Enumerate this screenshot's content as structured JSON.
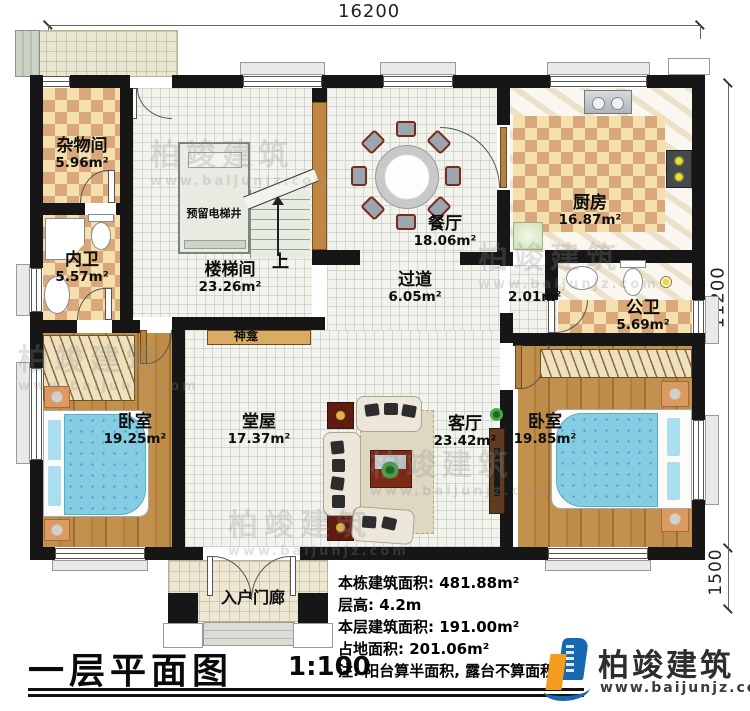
{
  "dimensions": {
    "top": "16200",
    "right": "11200",
    "porch": "1500"
  },
  "rooms": {
    "zawujian": {
      "name": "杂物间",
      "area": "5.96m²"
    },
    "neiwei": {
      "name": "内卫",
      "area": "5.57m²"
    },
    "loutijian": {
      "name": "楼梯间",
      "area": "23.26m²"
    },
    "canting": {
      "name": "餐厅",
      "area": "18.06m²"
    },
    "chufang": {
      "name": "厨房",
      "area": "16.87m²"
    },
    "guodao": {
      "name": "过道",
      "area": "6.05m²"
    },
    "corridor": {
      "area": "2.01m²"
    },
    "gongwei": {
      "name": "公卫",
      "area": "5.69m²"
    },
    "bedroom_left": {
      "name": "卧室",
      "area": "19.25m²"
    },
    "tangwu": {
      "name": "堂屋",
      "area": "17.37m²"
    },
    "keting": {
      "name": "客厅",
      "area": "23.42m²"
    },
    "bedroom_right": {
      "name": "卧室",
      "area": "19.85m²"
    },
    "porch": {
      "name": "入户门廊"
    }
  },
  "labels": {
    "elevator": "预留电梯井",
    "shrine": "神龛",
    "up": "上"
  },
  "title": {
    "text": "一层平面图",
    "scale": "1:100"
  },
  "info": {
    "line1": "本栋建筑面积: 481.88m²",
    "line2": "层高: 4.2m",
    "line3": "本层建筑面积: 191.00m²",
    "line4": "占地面积: 201.06m²",
    "line5": "注: 阳台算半面积, 露台不算面积"
  },
  "logo": {
    "name": "柏竣建筑",
    "url": "www.baijunjz.com"
  },
  "watermark": {
    "name": "柏竣建筑",
    "url": "www.baijunjz.com"
  },
  "colors": {
    "wall": "#161616",
    "checker_dark": "#d9a87a",
    "checker_light": "#f6dfae",
    "wood": "#b8873f",
    "bed_blue": "#85cde3",
    "logo_blue": "#1668b0",
    "logo_orange": "#f59b1d"
  }
}
